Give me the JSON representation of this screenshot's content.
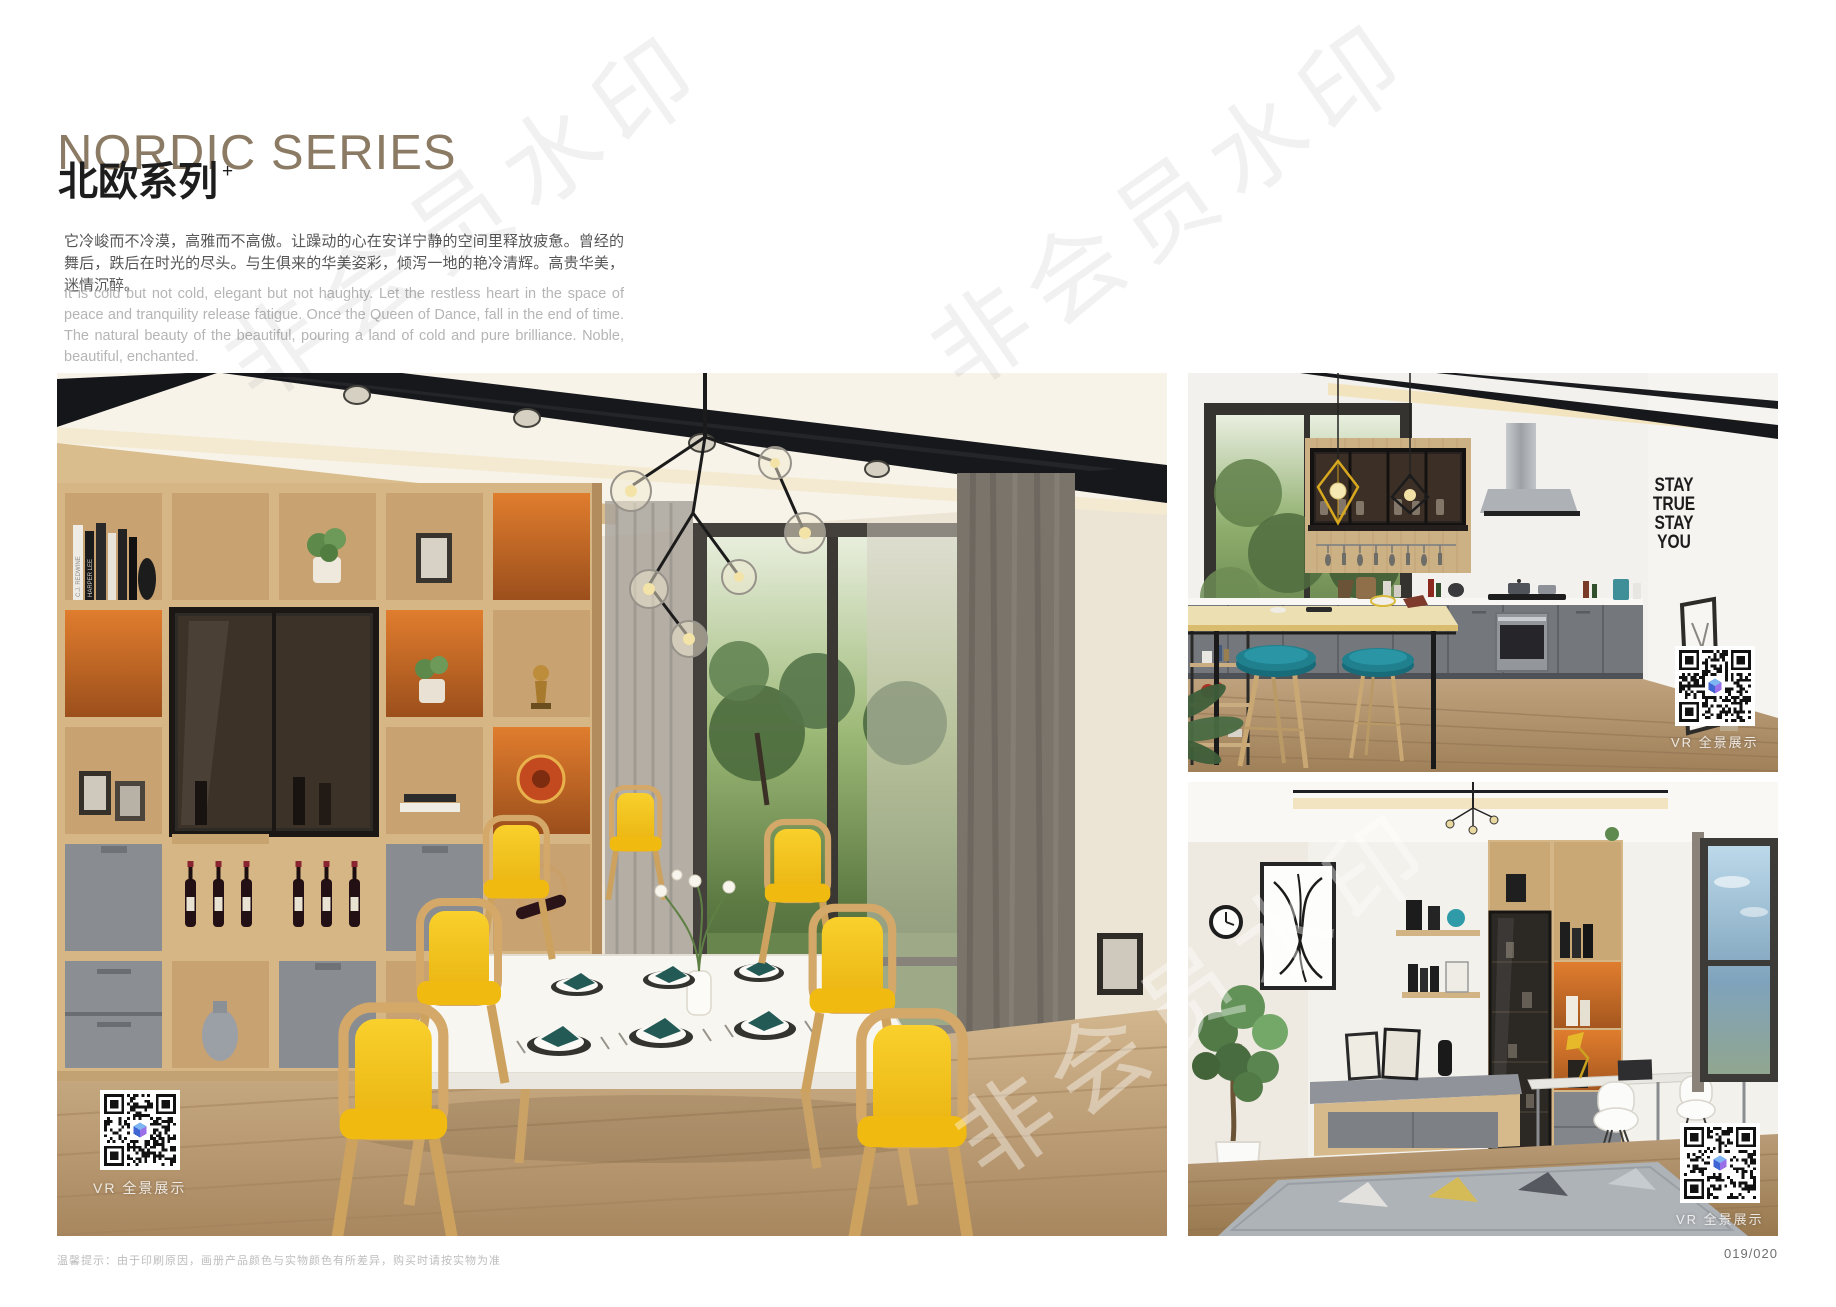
{
  "header": {
    "title_en": "NORDIC SERIES",
    "title_zh": "北欧系列",
    "title_sup": "+",
    "intro_zh": "它冷峻而不冷漠，高雅而不高傲。让躁动的心在安详宁静的空间里释放疲惫。曾经的舞后，跌后在时光的尽头。与生俱来的华美姿彩，倾泻一地的艳冷清辉。高贵华美，迷情沉醉。",
    "intro_en": "It is cold but not cold, elegant but not haughty. Let the restless heart in the space of peace and tranquility release fatigue. Once the Queen of Dance, fall in the end of time. The natural beauty of the beautiful, pouring a land of cold and pure brilliance. Noble, beautiful, enchanted."
  },
  "photos": {
    "dining": {
      "vr_label": "VR 全景展示",
      "book_spines": [
        "C.J. REDWINE",
        "HARPER LEE"
      ]
    },
    "kitchen": {
      "vr_label": "VR 全景展示",
      "wall_text_lines": [
        "STAY",
        "TRUE",
        "STAY",
        "YOU"
      ]
    },
    "study": {
      "vr_label": "VR 全景展示"
    }
  },
  "watermark": {
    "text": "非会员水印"
  },
  "footer": {
    "note": "温馨提示：由于印刷原因，画册产品颜色与实物颜色有所差异，购买时请按实物为准",
    "page_number": "019/020"
  },
  "colors": {
    "title_accent": "#8c7b64",
    "shelf_orange": "#cf6c28",
    "chair_yellow": "#f6c51d",
    "stool_teal": "#1f808f",
    "qr_logo_blue": "#4f7ee0"
  }
}
